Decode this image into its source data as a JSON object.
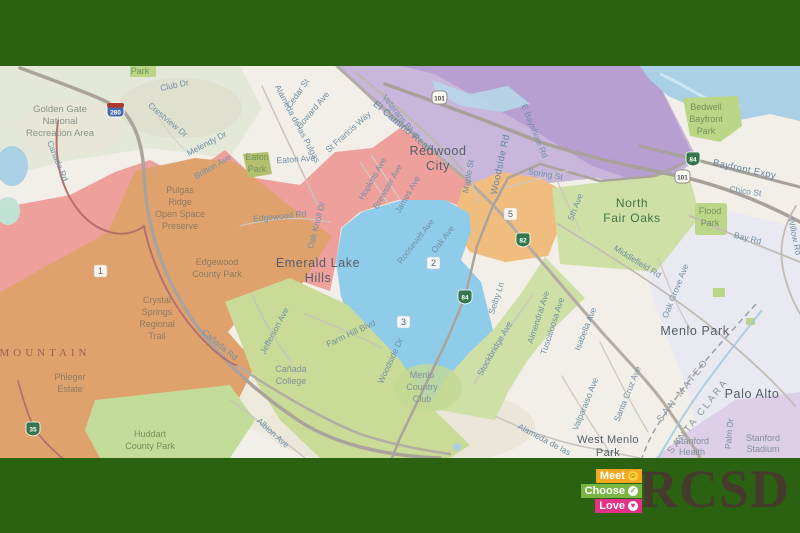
{
  "frame": {
    "color": "#2b6211"
  },
  "logo": {
    "badges": [
      {
        "label": "Meet",
        "color": "#f3a81f",
        "icon": "person-circle-icon"
      },
      {
        "label": "Choose",
        "color": "#79b543",
        "icon": "check-circle-icon"
      },
      {
        "label": "Love",
        "color": "#e23186",
        "icon": "heart-circle-icon"
      }
    ],
    "brand": "RCSD"
  },
  "map": {
    "colors": {
      "terrain": "#f1efe7",
      "terrain_sage": "#e3e8d8",
      "terrain_hills": "#e7e4d6",
      "water": "#a9d0e5",
      "water_soft": "#bfe2d4",
      "park_green": "#bcd687",
      "park_olive": "#b5c06e",
      "zone1_salmon": "#eea09d",
      "zone1_park_orange": "#dfa26d",
      "zone2_blue": "#8fccea",
      "zone3_green": "#c9db96",
      "zone3_green_light": "#cfe0a6",
      "zone5_orange": "#f0bd7e",
      "zone4_purple": "#c9b6db",
      "zone4_purple_dark": "#b79fd1",
      "menlo_lavender": "#e8e7f2",
      "stanford_purple": "#dccfe7",
      "huddart_green": "#c4dc9a",
      "golf_green": "#c3d893"
    },
    "zone_labels": {
      "z1": "1",
      "z2": "2",
      "z3": "3",
      "z5": "5"
    },
    "shields": {
      "i280": "280",
      "us101": "101",
      "ca84": "84",
      "ca82": "82",
      "ca35": "35"
    },
    "cities": {
      "redwood_city": [
        "Redwood",
        "City"
      ],
      "north_fair_oaks": [
        "North",
        "Fair Oaks"
      ],
      "menlo_park": "Menlo Park",
      "palo_alto": "Palo Alto",
      "west_menlo_park": [
        "West Menlo",
        "Park"
      ],
      "emerald_lake_hills": [
        "Emerald Lake",
        "Hills"
      ],
      "mountain": "MOUNTAIN"
    },
    "counties": {
      "san_mateo": "SAN MATEO",
      "santa_clara": "SANTA CLARA"
    },
    "parks": {
      "park_top": "Park",
      "golden_gate": [
        "Golden Gate",
        "National",
        "Recreation Area"
      ],
      "eaton_park": [
        "Eaton",
        "Park"
      ],
      "pulgas_ridge": [
        "Pulgas",
        "Ridge",
        "Open Space",
        "Preserve"
      ],
      "edgewood_county_park": [
        "Edgewood",
        "County Park"
      ],
      "crystal_springs": [
        "Crystal",
        "Springs",
        "Regional",
        "Trail"
      ],
      "phleger_estate": [
        "Phleger",
        "Estate"
      ],
      "huddart_county_park": [
        "Huddart",
        "County Park"
      ],
      "bedwell_bayfront_park": [
        "Bedwell",
        "Bayfront",
        "Park"
      ],
      "flood_park": [
        "Flood",
        "Park"
      ],
      "canada_college": [
        "Cañada",
        "College"
      ],
      "menlo_country_club": [
        "Menlo",
        "Country",
        "Club"
      ],
      "stanford_health": [
        "Stanford",
        "Health"
      ],
      "stanford_stadium": [
        "Stanford",
        "Stadium"
      ]
    },
    "roads": {
      "el_camino_real": "El Camino Real",
      "veterans_blvd": "Veterans Blvd",
      "bayfront_expy": "Bayfront Expy",
      "e_bayshore_rd": "E Bayshore Rd",
      "woodside_rd": "Woodside Rd",
      "bay_rd": "Bay Rd",
      "willow_rd": "Willow Rd",
      "middlefield_rd": "Middlefield Rd",
      "oak_grove_ave": "Oak Grove Ave",
      "santa_cruz_ave": "Santa Cruz Ave",
      "valparaiso_ave": "Valparaiso Ave",
      "isabella_ave": "Isabella Ave",
      "alameda_de_las_pulgas": "Alameda de las Pulgas",
      "alameda_de_las": "Alameda de las",
      "st_francis_way": "St Francis Way",
      "hopkins_ave": "Hopkins Ave",
      "brewster_ave": "Brewster Ave",
      "james_ave": "James Ave",
      "roosevelt_ave": "Roosevelt Ave",
      "oak_ave": "Oak Ave",
      "maple_st": "Maple St",
      "spring_st": "Spring St",
      "fifth_ave": "5th Ave",
      "selby_ln": "Selby Ln",
      "stockbridge_ave": "Stockbridge Ave",
      "almendral_ave": "Almendral Ave",
      "tuscaloosa_ave": "Tuscaloosa Ave",
      "edgewood_rd": "Edgewood Rd",
      "oak_knoll_dr": "Oak Knoll Dr",
      "canada_rd": "Cañada Rd",
      "club_dr": "Club Dr",
      "crestview_dr": "Crestview Dr",
      "melendy_dr": "Melendy Dr",
      "britton_ave": "Britton Ave",
      "eaton_ave": "Eaton Ave",
      "cedar_st": "Cedar St",
      "howard_ave": "Howard Ave",
      "jefferson_ave": "Jefferson Ave",
      "farm_hill_blvd": "Farm Hill Blvd",
      "albion_ave": "Albion Ave",
      "woodside_dr": "Woodside Dr",
      "chico_st": "Chico St",
      "palm_dr": "Palm Dr"
    }
  }
}
